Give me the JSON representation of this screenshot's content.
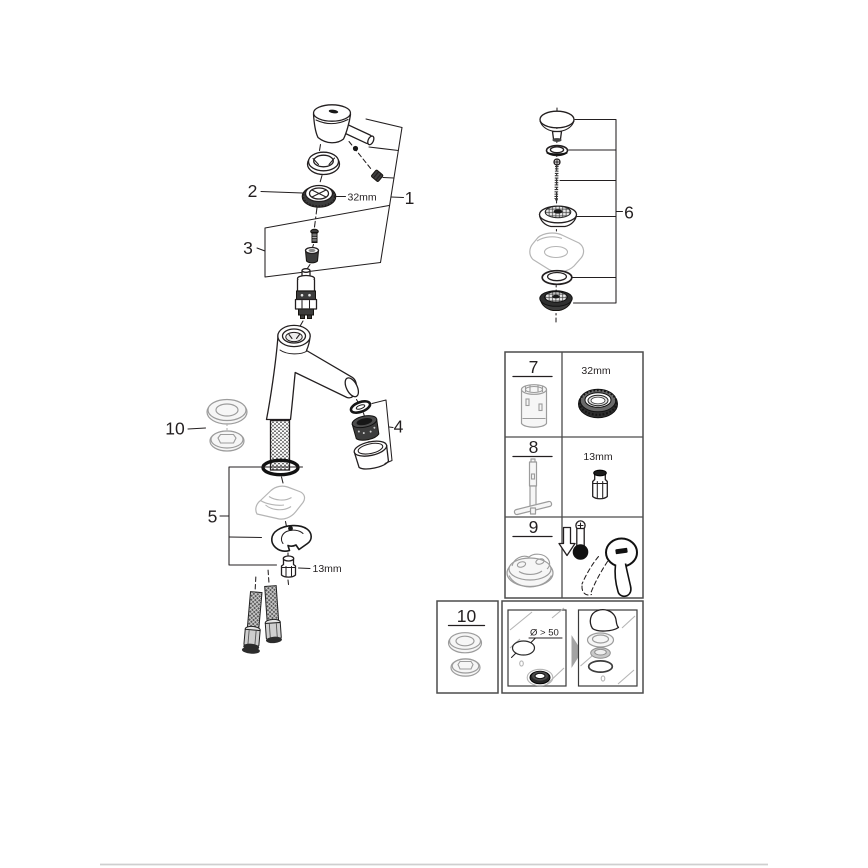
{
  "page": {
    "background": "#ffffff",
    "footer_divider_color": "#cfcfcf"
  },
  "exploded_view": {
    "callouts": {
      "handle_group": "1",
      "ring_nut": "2",
      "screw_and_cap": "3",
      "aerator_group": "4",
      "mounting_group": "5",
      "base_gaskets": "10"
    },
    "dimensions": {
      "ring_nut": "32mm",
      "mounting_nut": "13mm"
    }
  },
  "drain_assembly": {
    "callout": "6"
  },
  "service_parts_table": {
    "row_7": {
      "label": "7",
      "size": "32mm"
    },
    "row_8": {
      "label": "8",
      "size": "13mm"
    },
    "row_9": {
      "label": "9"
    }
  },
  "seal_kit_box": {
    "label": "10"
  },
  "install_note_box": {
    "hole_dimension": "Ø > 50"
  }
}
